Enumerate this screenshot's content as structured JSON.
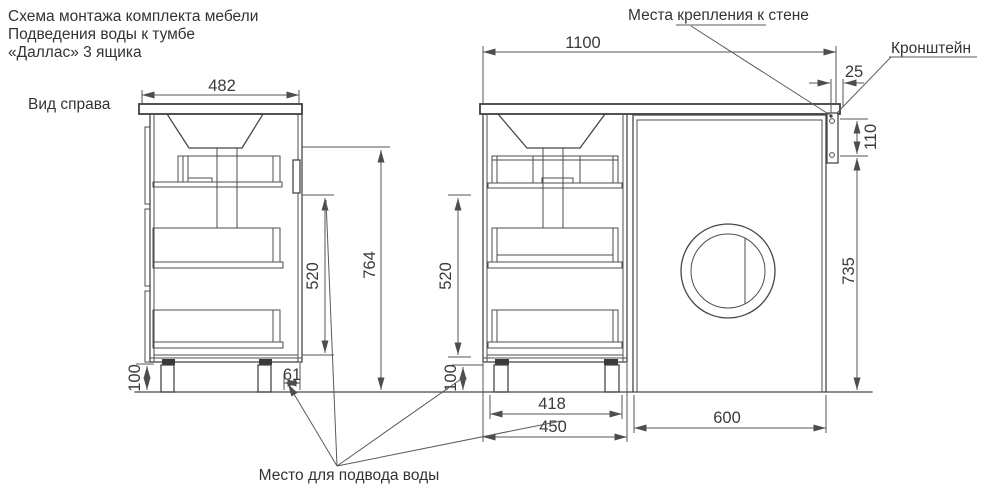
{
  "colors": {
    "background": "#ffffff",
    "line": "#474747",
    "text": "#333333"
  },
  "title": {
    "line1": "Схема монтажа комплекта мебели",
    "line2": "Подведения воды к тумбе",
    "line3": "«Даллас» 3 ящика"
  },
  "side_view": {
    "label": "Вид справа",
    "dim_width": "482",
    "dim_height": "764",
    "dim_drawers": "520",
    "dim_legs": "100",
    "dim_water_offset": "61"
  },
  "front_view": {
    "dim_total_width": "1100",
    "dim_overhang": "25",
    "dim_bracket_holes": "110",
    "dim_washer_height": "735",
    "dim_drawers": "520",
    "dim_legs": "100",
    "dim_leg_span": "418",
    "dim_cabinet_width": "450",
    "dim_washer_width": "600"
  },
  "callouts": {
    "wall_mount": "Места крепления к стене",
    "bracket": "Кронштейн",
    "water_supply": "Место для подвода воды"
  }
}
